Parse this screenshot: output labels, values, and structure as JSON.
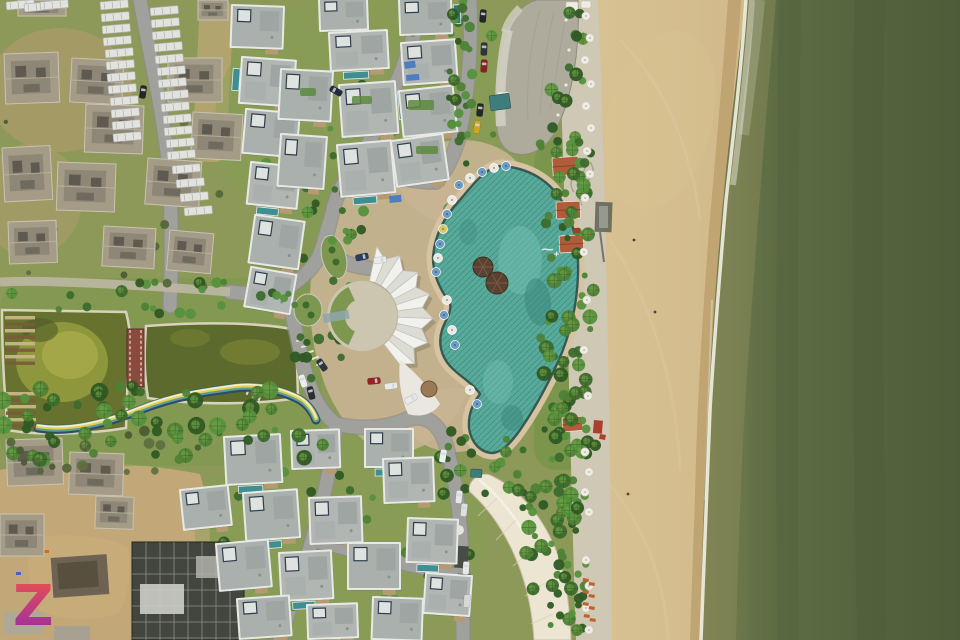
{
  "image": {
    "watermark": {
      "text": "Z",
      "gradient_top": "#ef5546",
      "gradient_mid": "#c23d7e",
      "gradient_bottom": "#8c2da6"
    }
  },
  "palette": {
    "ocean_deep": "#4d5d39",
    "ocean_mid": "#5a6a42",
    "ocean_shallow": "#87895a",
    "foam": "#f2efe2",
    "sand_light": "#d8c294",
    "sand_dark": "#c6ac7d",
    "sand_wet": "#b99d6b",
    "walkway": "#cfc8b4",
    "road": "#a0a09c",
    "road_edge": "#8d8d89",
    "path_pale": "#bdb7a4",
    "grass_base": "#8d9958",
    "grass_light": "#84a054",
    "dirt": "#b49b6f",
    "construction_dirt": "#c2a878",
    "pond_left": "#67722f",
    "pond_right": "#5d6a2d",
    "algae": "#9aa040",
    "pond_edge": "#d8d2bc",
    "bridge_red": "#8a4a3e",
    "rainbow_navy": "#2e4a6e",
    "rainbow_teal": "#5e9e8e",
    "rainbow_yellow": "#e3cf52",
    "rainbow_white": "#f2eede",
    "pool": "#58aa9b",
    "pool_dark": "#38837a",
    "pool_light": "#7ac6b6",
    "pool_gutter": "#2e4f48",
    "deck": "#d6c3a1",
    "plaza": "#c9b493",
    "fan_light": "#f1f1ed",
    "fan_dark": "#dcdcd5",
    "fan_line": "#c2c2ba",
    "fan_garden": "#7d9750",
    "fan_pergola": "#8fa4ad",
    "roof": "#b2b6b2",
    "roof_alt": "#aab0ac",
    "parapet": "#e7e9e6",
    "roof_sub": "#9fa5a3",
    "concrete": "#a59c88",
    "concrete_dark": "#8e8677",
    "concrete_hole": "#5e5a50",
    "curved_roof": "#aeab9d",
    "curved_roof_light": "#d2cfc2",
    "cream_building": "#ece5d2",
    "dark_structure": "#42463f",
    "cabana": "#b05c3a",
    "thatch": "#5a4232",
    "umbrella_blue": "#6f9cc4",
    "umbrella_white": "#eae8e0",
    "umbrella_yellow": "#d9c766",
    "lounger_orange": "#c4602c",
    "tarp_blue": "#4a7ac0",
    "tree_palette": [
      "#3c6b2c",
      "#2f5a24",
      "#4e8236",
      "#55913d"
    ],
    "tree_dark_palette": [
      "#55663a",
      "#4a5c33",
      "#5e7040"
    ]
  },
  "scene": {
    "roads": [
      "M140,0 C150,55 162,108 168,160 C172,210 172,260 170,306",
      "M424,0 C410,55 385,115 362,155 C350,172 340,186 334,205 C330,222 326,240 318,258 C310,272 298,282 284,290 C266,296 246,294 230,292",
      "M283,289 C292,306 296,335 303,363 C310,392 320,412 336,424",
      "M336,424 C333,458 324,498 312,540 C301,582 287,612 280,640",
      "M336,424 C360,430 385,428 405,420 C428,412 442,426 448,452 C456,482 461,520 462,560 C463,600 463,620 463,640",
      "M312,540 C360,552 410,566 462,576",
      "M470,0 C472,50 468,100 458,140 C452,160 445,172 436,182",
      "M326,250 C340,262 352,266 368,268",
      "M358,165 C382,176 404,180 430,182"
    ],
    "pale_path": "M230,292 C180,288 120,284 60,282 C40,281 18,281 0,282",
    "rainbow_d": "M38,428 C70,433 105,424 140,410 C175,396 205,392 235,388 C262,385 285,392 300,400 C308,405 313,412 316,420",
    "pool_d": "M502,166 C530,168 552,182 564,205 C574,224 579,248 578,275 C577,305 570,335 558,362 C547,386 534,410 520,430 C510,444 502,452 493,453 C481,453 471,443 469,428 C468,415 473,403 480,394 C473,383 460,377 450,366 C441,356 438,343 442,330 C445,320 452,313 450,303 C441,291 433,276 433,258 C434,237 444,217 458,202 C470,189 485,166 502,166 Z",
    "fan": {
      "cx": 362,
      "cy": 316,
      "r_inner": 36,
      "r_outer": 66,
      "amp": 5,
      "a0": -78,
      "a1": 52,
      "pleats": 13
    },
    "villas_finished": [
      [
        233,
        6,
        50,
        40,
        2,
        0
      ],
      [
        243,
        58,
        52,
        44,
        4,
        2
      ],
      [
        247,
        110,
        52,
        42,
        5,
        0
      ],
      [
        252,
        163,
        48,
        40,
        6,
        1
      ],
      [
        256,
        216,
        48,
        46,
        8,
        0
      ],
      [
        252,
        268,
        44,
        38,
        10,
        0
      ],
      [
        320,
        0,
        46,
        30,
        -2,
        0
      ],
      [
        330,
        34,
        56,
        36,
        -3,
        1
      ],
      [
        282,
        70,
        50,
        48,
        3,
        0
      ],
      [
        340,
        86,
        54,
        50,
        -4,
        3
      ],
      [
        282,
        135,
        44,
        50,
        4,
        0
      ],
      [
        338,
        146,
        52,
        50,
        -5,
        1
      ],
      [
        400,
        0,
        50,
        34,
        -2,
        3
      ],
      [
        402,
        44,
        52,
        40,
        -4,
        0
      ],
      [
        400,
        92,
        52,
        44,
        -6,
        0
      ],
      [
        392,
        142,
        50,
        44,
        -8,
        0
      ],
      [
        225,
        438,
        54,
        46,
        -3,
        1
      ],
      [
        292,
        432,
        46,
        36,
        -2,
        0
      ],
      [
        366,
        430,
        46,
        36,
        0,
        1
      ],
      [
        384,
        460,
        48,
        42,
        -2,
        0
      ],
      [
        244,
        494,
        52,
        46,
        -4,
        1
      ],
      [
        310,
        499,
        50,
        44,
        -2,
        0
      ],
      [
        217,
        545,
        50,
        45,
        -5,
        0
      ],
      [
        280,
        554,
        50,
        46,
        -3,
        1
      ],
      [
        349,
        544,
        50,
        44,
        0,
        0
      ],
      [
        409,
        519,
        48,
        42,
        2,
        1
      ],
      [
        238,
        600,
        50,
        38,
        -4,
        0
      ],
      [
        308,
        606,
        48,
        32,
        -2,
        1
      ],
      [
        374,
        598,
        48,
        40,
        2,
        0
      ],
      [
        427,
        574,
        44,
        38,
        4,
        0
      ],
      [
        181,
        491,
        46,
        38,
        -6,
        0
      ]
    ],
    "villas_construction": [
      [
        4,
        54,
        54,
        50,
        -2
      ],
      [
        72,
        58,
        52,
        44,
        3
      ],
      [
        86,
        104,
        58,
        48,
        2
      ],
      [
        168,
        58,
        54,
        44,
        0
      ],
      [
        193,
        112,
        50,
        46,
        3
      ],
      [
        2,
        148,
        48,
        54,
        -3
      ],
      [
        58,
        162,
        58,
        48,
        2
      ],
      [
        148,
        158,
        54,
        46,
        4
      ],
      [
        18,
        0,
        48,
        16,
        0
      ],
      [
        198,
        0,
        30,
        20,
        0
      ],
      [
        8,
        222,
        48,
        42,
        -2
      ],
      [
        104,
        226,
        52,
        40,
        3
      ],
      [
        170,
        230,
        44,
        40,
        5
      ],
      [
        6,
        440,
        56,
        46,
        -2
      ],
      [
        70,
        452,
        54,
        42,
        2
      ],
      [
        0,
        514,
        44,
        42,
        0
      ],
      [
        96,
        496,
        38,
        32,
        2
      ]
    ],
    "stacks": [
      [
        100,
        2
      ],
      [
        101,
        14
      ],
      [
        102,
        26
      ],
      [
        103,
        38
      ],
      [
        105,
        50
      ],
      [
        106,
        62
      ],
      [
        107,
        74
      ],
      [
        108,
        86
      ],
      [
        110,
        98
      ],
      [
        111,
        110
      ],
      [
        112,
        122
      ],
      [
        113,
        134
      ],
      [
        150,
        8
      ],
      [
        151,
        20
      ],
      [
        152,
        32
      ],
      [
        154,
        44
      ],
      [
        155,
        56
      ],
      [
        157,
        68
      ],
      [
        158,
        80
      ],
      [
        160,
        92
      ],
      [
        161,
        104
      ],
      [
        163,
        116
      ],
      [
        164,
        128
      ],
      [
        166,
        140
      ],
      [
        167,
        152
      ],
      [
        172,
        166
      ],
      [
        176,
        180
      ],
      [
        180,
        194
      ],
      [
        184,
        208
      ],
      [
        6,
        2
      ],
      [
        24,
        4
      ],
      [
        40,
        2
      ]
    ],
    "tarps": [
      [
        404,
        62,
        11,
        7,
        -8
      ],
      [
        406,
        75,
        13,
        6,
        -5
      ],
      [
        389,
        196,
        12,
        7,
        -6
      ]
    ],
    "roof_gardens": [
      [
        408,
        100,
        26,
        10
      ],
      [
        416,
        146,
        22,
        8
      ],
      [
        352,
        96,
        20,
        8
      ],
      [
        300,
        88,
        16,
        8
      ]
    ],
    "cabanas": [
      [
        552,
        158,
        -4,
        26,
        18
      ],
      [
        556,
        202,
        -2,
        24,
        17
      ],
      [
        559,
        236,
        -3,
        24,
        17
      ],
      [
        562,
        418,
        -5,
        20,
        14
      ]
    ],
    "tents": [
      [
        566,
        2,
        12,
        9
      ],
      [
        581,
        1,
        10,
        7
      ],
      [
        497,
        92,
        12,
        9
      ]
    ],
    "utility_roofs": [
      [
        489,
        96,
        20,
        15,
        -8
      ],
      [
        471,
        469,
        11,
        8,
        3
      ]
    ],
    "red_bits": [
      [
        594,
        420,
        9,
        13,
        5
      ],
      [
        600,
        434,
        6,
        5,
        10
      ],
      [
        574,
        228,
        6,
        5,
        0
      ]
    ],
    "cars": [
      [
        483,
        16,
        4,
        "#26262a"
      ],
      [
        484,
        49,
        2,
        "#30343a"
      ],
      [
        484,
        66,
        3,
        "#8a2026"
      ],
      [
        480,
        110,
        6,
        "#26262a"
      ],
      [
        477,
        127,
        8,
        "#d4a41f"
      ],
      [
        336,
        91,
        -60,
        "#222c3e"
      ],
      [
        143,
        92,
        8,
        "#26262a"
      ],
      [
        362,
        257,
        78,
        "#2e3a5e"
      ],
      [
        380,
        260,
        82,
        "#e9ebeb"
      ],
      [
        322,
        365,
        -35,
        "#2e3440"
      ],
      [
        303,
        381,
        -18,
        "#eceff0"
      ],
      [
        311,
        393,
        -14,
        "#2a2e34"
      ],
      [
        374,
        381,
        84,
        "#9a2028"
      ],
      [
        391,
        386,
        82,
        "#e8eaea"
      ],
      [
        411,
        399,
        60,
        "#e8eaea"
      ],
      [
        443,
        456,
        10,
        "#eceff0"
      ],
      [
        459,
        497,
        6,
        "#e6e8e8"
      ],
      [
        464,
        510,
        6,
        "#dfe1e1"
      ],
      [
        466,
        568,
        4,
        "#e8e8e8"
      ],
      [
        467,
        601,
        3,
        "#d8d8d8"
      ]
    ],
    "pool_umbrellas": [
      [
        459,
        185,
        "b"
      ],
      [
        470,
        178,
        "w"
      ],
      [
        482,
        172,
        "b"
      ],
      [
        494,
        168,
        "w"
      ],
      [
        506,
        166,
        "b"
      ],
      [
        452,
        200,
        "w"
      ],
      [
        447,
        214,
        "b"
      ],
      [
        443,
        229,
        "y"
      ],
      [
        440,
        244,
        "b"
      ],
      [
        438,
        258,
        "w"
      ],
      [
        436,
        272,
        "b"
      ],
      [
        447,
        300,
        "w"
      ],
      [
        444,
        315,
        "b"
      ],
      [
        452,
        330,
        "w"
      ],
      [
        455,
        345,
        "b"
      ],
      [
        470,
        390,
        "w"
      ],
      [
        477,
        404,
        "b"
      ]
    ],
    "thatch_umbrellas": [
      [
        483,
        267,
        10
      ],
      [
        497,
        283,
        11
      ]
    ],
    "beach_umbrellas": [
      [
        586,
        16
      ],
      [
        590,
        38
      ],
      [
        585,
        60
      ],
      [
        591,
        84
      ],
      [
        586,
        106
      ],
      [
        591,
        128
      ],
      [
        587,
        151
      ],
      [
        590,
        174
      ],
      [
        585,
        198
      ],
      [
        584,
        252
      ],
      [
        587,
        300
      ],
      [
        584,
        350
      ],
      [
        588,
        396
      ],
      [
        585,
        452
      ],
      [
        589,
        472
      ],
      [
        585,
        492
      ],
      [
        589,
        512
      ],
      [
        586,
        560
      ],
      [
        589,
        586
      ],
      [
        586,
        608
      ],
      [
        589,
        630
      ]
    ],
    "loungers": [
      [
        583,
        578
      ],
      [
        589,
        582
      ],
      [
        583,
        590
      ],
      [
        589,
        594
      ],
      [
        583,
        602
      ],
      [
        589,
        606
      ],
      [
        584,
        614
      ],
      [
        590,
        618
      ]
    ],
    "people": [
      [
        634,
        240
      ],
      [
        655,
        312
      ],
      [
        628,
        494
      ]
    ],
    "parking_dashes": [
      [
        300,
        340,
        70
      ],
      [
        305,
        346,
        70
      ],
      [
        310,
        352,
        70
      ],
      [
        315,
        358,
        70
      ],
      [
        320,
        364,
        70
      ],
      [
        242,
        388,
        20
      ],
      [
        248,
        391,
        20
      ],
      [
        254,
        394,
        20
      ],
      [
        260,
        397,
        20
      ]
    ],
    "weirs": [
      {
        "x": 5,
        "y": 316,
        "w": 30,
        "n": 8,
        "gap": 6.5
      },
      {
        "x": 6,
        "y": 392,
        "w": 30,
        "n": 6,
        "gap": 6.5
      }
    ],
    "tree_zones_under": [
      [
        238,
        0,
        300,
        250,
        48,
        3,
        6,
        11,
        0
      ],
      [
        210,
        428,
        265,
        205,
        40,
        3,
        6,
        21,
        0
      ],
      [
        4,
        4,
        225,
        290,
        20,
        2,
        5,
        31,
        1
      ],
      [
        292,
        296,
        56,
        86,
        12,
        3,
        6,
        41,
        0
      ],
      [
        298,
        180,
        56,
        110,
        12,
        3,
        6,
        51,
        0
      ]
    ],
    "tree_zones_over": [
      [
        551,
        0,
        36,
        636,
        66,
        3,
        7,
        61,
        0
      ],
      [
        536,
        142,
        60,
        322,
        52,
        3,
        8,
        71,
        0
      ],
      [
        0,
        386,
        324,
        74,
        55,
        4,
        9,
        81,
        0
      ],
      [
        0,
        282,
        300,
        32,
        24,
        3,
        6,
        91,
        0
      ],
      [
        448,
        8,
        28,
        152,
        22,
        3,
        6,
        101,
        0
      ],
      [
        521,
        470,
        58,
        168,
        36,
        3,
        8,
        111,
        0
      ],
      [
        440,
        438,
        92,
        58,
        18,
        3,
        7,
        121,
        0
      ],
      [
        0,
        428,
        210,
        44,
        16,
        3,
        6,
        131,
        1
      ]
    ]
  }
}
